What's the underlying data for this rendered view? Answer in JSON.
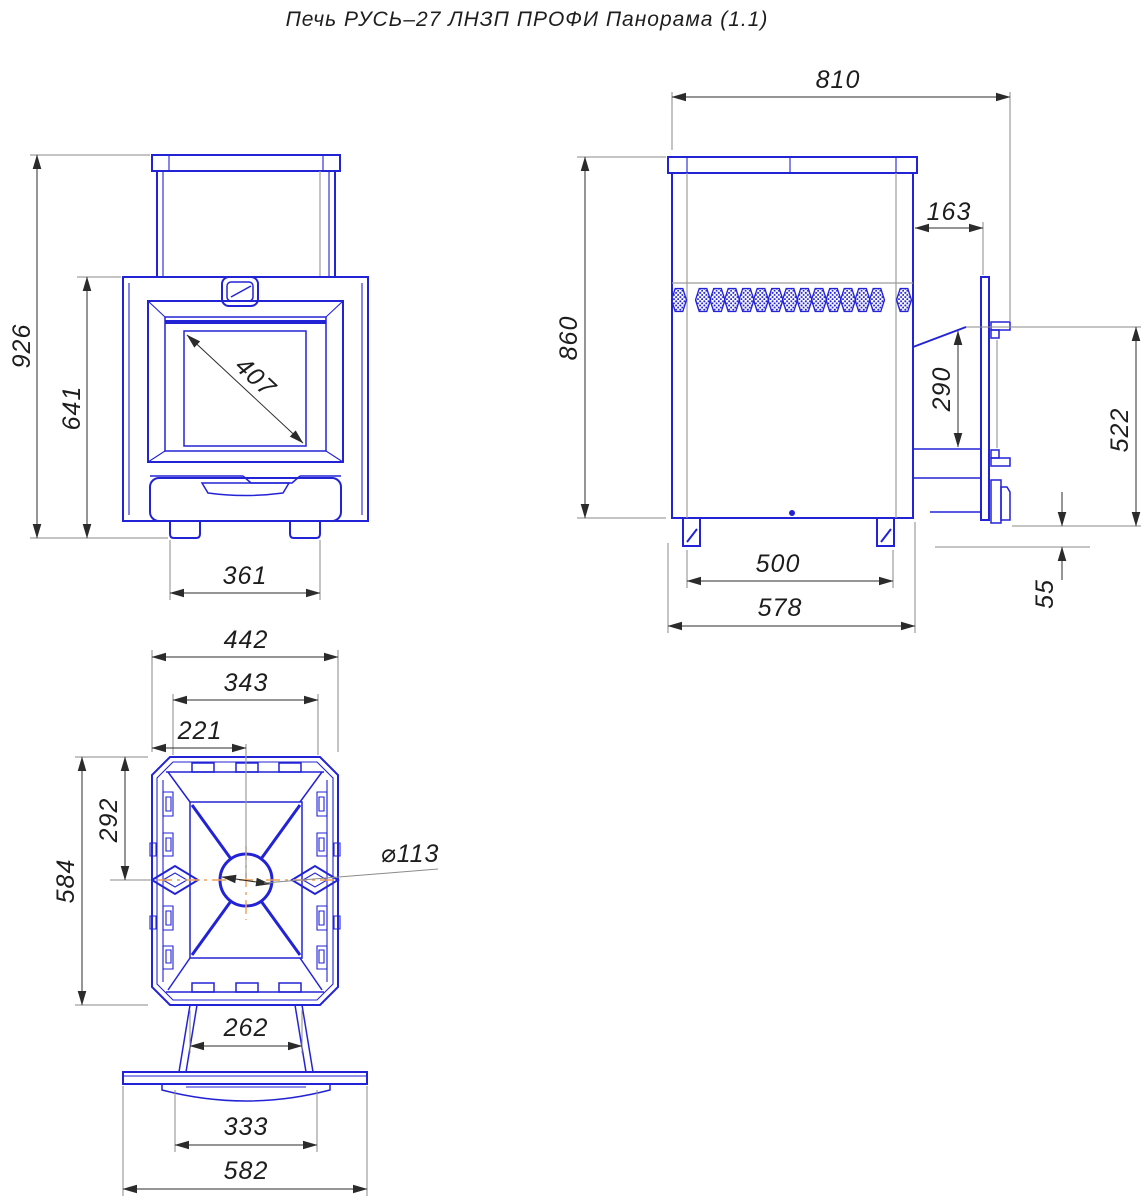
{
  "title": "Печь РУСЬ–27 ЛНЗП ПРОФИ Панорама (1.1)",
  "colors": {
    "line_blue": "#2323d6",
    "dim_dark": "#2b2b2b",
    "thin_gray": "#8a8a8a",
    "center_orange": "#f0a055"
  },
  "views": {
    "front": {
      "name": "front view",
      "dims": {
        "overall_height": "926",
        "firebox_height": "641",
        "glass_diagonal": "407",
        "feet_width": "361"
      }
    },
    "side": {
      "name": "side view",
      "dims": {
        "total_depth": "810",
        "body_height": "860",
        "door_offset": "163",
        "door_glass_height": "290",
        "door_height": "522",
        "floor_gap": "55",
        "feet_span": "500",
        "body_depth": "578"
      }
    },
    "top": {
      "name": "top view",
      "dims": {
        "body_width": "442",
        "inner_width": "343",
        "center_offset": "221",
        "body_depth": "584",
        "center_depth": "292",
        "chimney_diameter": "⌀113",
        "front_width": "262",
        "shield_width": "333",
        "base_width": "582"
      }
    }
  }
}
